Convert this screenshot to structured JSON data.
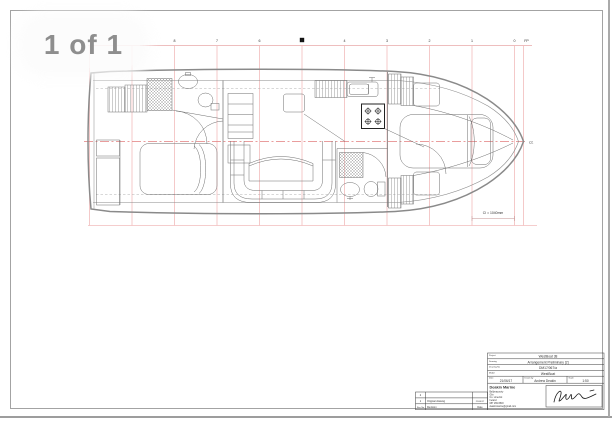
{
  "viewer": {
    "page_indicator": "1 of 1"
  },
  "sheet": {
    "stations": [
      "8",
      "7",
      "6",
      "5",
      "4",
      "3",
      "2",
      "1",
      "0",
      "FP"
    ],
    "dimension_note": "CI = 1040mm",
    "centerline_symbol": "CL"
  },
  "title_block": {
    "fields": [
      {
        "label": "Project",
        "value": "WestBoat 38"
      },
      {
        "label": "Drawing",
        "value": "Arrangement Preliminary [2]"
      },
      {
        "label": "Drawing No",
        "value": "DM17/067/a"
      },
      {
        "label": "Model",
        "value": "WestBoat"
      }
    ],
    "meta": [
      {
        "label": "Date",
        "value": "21/06/17"
      },
      {
        "label": "Drawn by",
        "value": "Andrew Deakin"
      },
      {
        "label": "Scale",
        "value": "1:50"
      }
    ],
    "company": {
      "name": "Deakin Marine",
      "address_lines": [
        "Ballynacourty",
        "Glin",
        "Co. Limerick",
        "Ireland",
        "087 269 8818",
        "deakinmarine@gmail.com"
      ]
    }
  },
  "revision_table": {
    "header": [
      "Rev. No",
      "Revision",
      "Date"
    ],
    "rows": [
      {
        "no": "2",
        "revision": "",
        "date": ""
      },
      {
        "no": "1",
        "revision": "Original drawing",
        "date": "21/06/17"
      }
    ]
  },
  "colors": {
    "grid": "#f2bcbc",
    "centerline": "#e27d7d",
    "hull": "#8a8a8a",
    "detail": "#6e6e6e",
    "dimension": "#a06a6a"
  }
}
